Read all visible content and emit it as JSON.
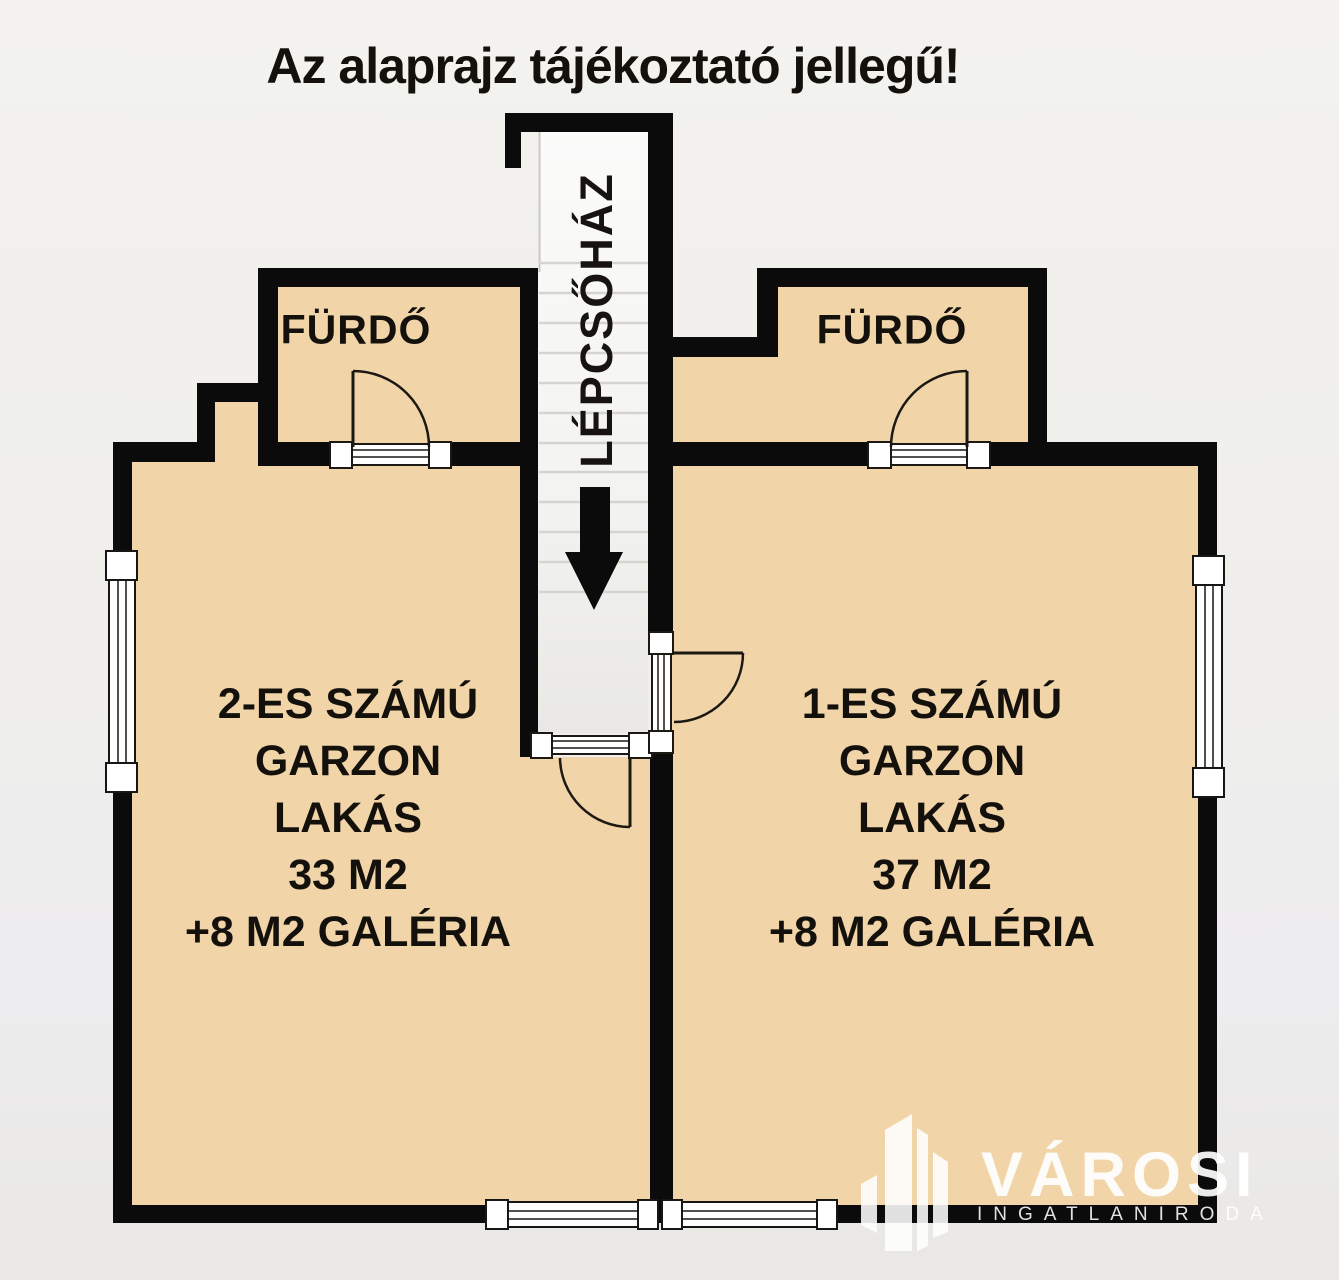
{
  "title": "Az alaprajz tájékoztató jellegű!",
  "stairwell": {
    "label": "LÉPCSŐHÁZ",
    "arrow_direction": "down"
  },
  "apartments": [
    {
      "number": "2",
      "bathroom_label": "FÜRDŐ",
      "lines": [
        "2-ES SZÁMÚ",
        "GARZON",
        "LAKÁS",
        "33 M2",
        "+8 M2 GALÉRIA"
      ]
    },
    {
      "number": "1",
      "bathroom_label": "FÜRDŐ",
      "lines": [
        "1-ES SZÁMÚ",
        "GARZON",
        "LAKÁS",
        "37 M2",
        "+8 M2 GALÉRIA"
      ]
    }
  ],
  "watermark": {
    "name": "VÁROSI",
    "subtitle": "INGATLANIRODA"
  },
  "colors": {
    "floor": "#f1d5a9",
    "wall": "#0b0b0b",
    "background": "#f0efeb",
    "stair_fill": "#f7f7f5",
    "opening_fill": "#ffffff",
    "watermark": "#ffffff"
  }
}
